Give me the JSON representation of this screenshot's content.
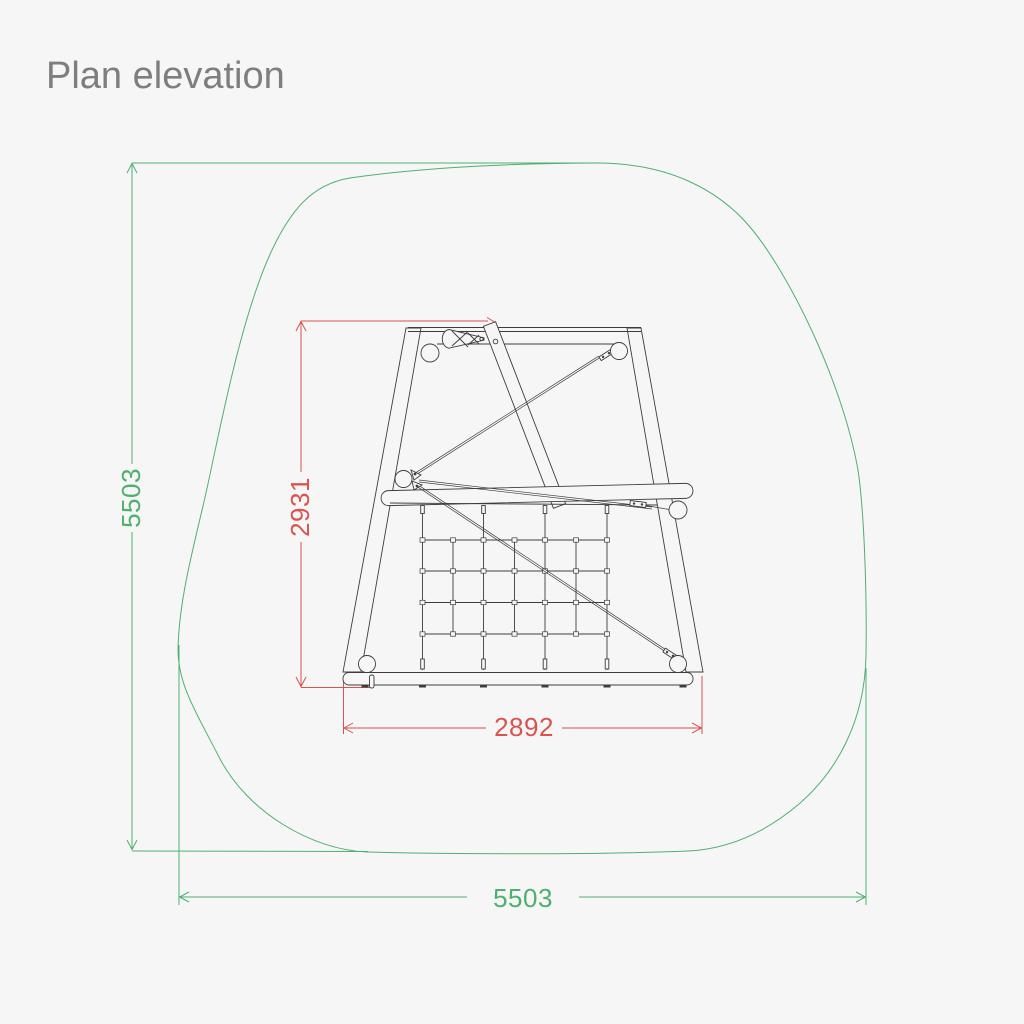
{
  "page": {
    "title": "Plan elevation"
  },
  "dimensions": {
    "safety_zone_height": {
      "value": "5503",
      "unit": "mm",
      "orientation": "vertical",
      "color": "green"
    },
    "safety_zone_width": {
      "value": "5503",
      "unit": "mm",
      "orientation": "horizontal",
      "color": "green"
    },
    "structure_height": {
      "value": "2931",
      "unit": "mm",
      "orientation": "vertical",
      "color": "red"
    },
    "structure_width": {
      "value": "2892",
      "unit": "mm",
      "orientation": "horizontal",
      "color": "red"
    }
  },
  "colors": {
    "background": "#f6f6f6",
    "safety_zone_green": "#4eb06e",
    "structure_dimension_red": "#d9534f",
    "structure_line": "#3d3d3d",
    "title_gray": "#7e7e7e"
  }
}
